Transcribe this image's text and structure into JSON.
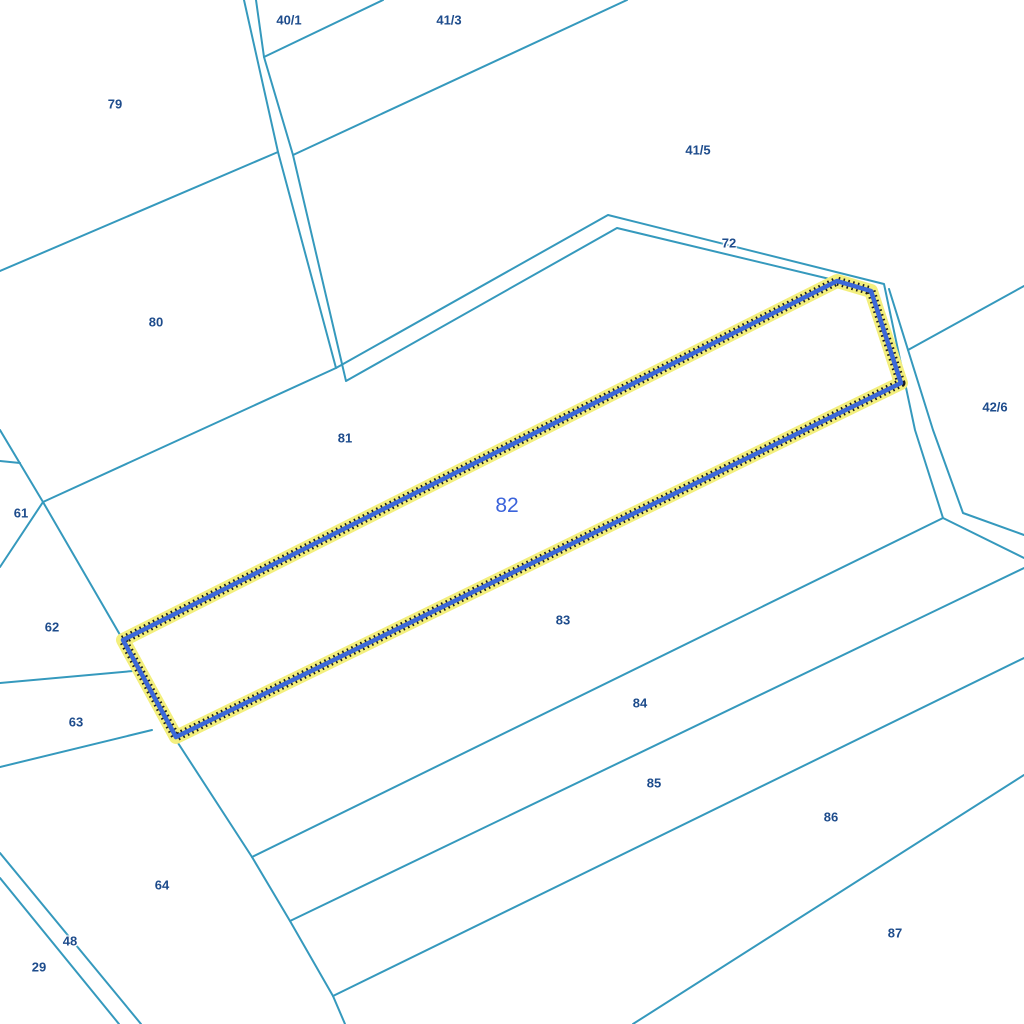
{
  "map": {
    "background_color": "#ffffff",
    "boundary_color": "#3599bd",
    "boundary_width": 2,
    "label_color": "#1e4c8c",
    "selected_label_color": "#3b63db",
    "highlight": {
      "halo_color": "#f3ef7d",
      "halo_width": 14,
      "dotted_color": "#1b1b1b",
      "dotted_width": 9,
      "dotted_dash": "1.6 3.4",
      "stroke_color": "#3c68d8",
      "stroke_width": 4.5
    },
    "selected_parcel": {
      "id": "82",
      "label_x": 507,
      "label_y": 506,
      "polygon": "123,640 837,281 871,291 901,383 176,737"
    },
    "parcels": [
      {
        "id": "79",
        "x": 115,
        "y": 104
      },
      {
        "id": "40/1",
        "x": 289,
        "y": 20
      },
      {
        "id": "41/3",
        "x": 449,
        "y": 20
      },
      {
        "id": "41/5",
        "x": 698,
        "y": 150
      },
      {
        "id": "72",
        "x": 729,
        "y": 243
      },
      {
        "id": "80",
        "x": 156,
        "y": 322
      },
      {
        "id": "42/6",
        "x": 995,
        "y": 407
      },
      {
        "id": "81",
        "x": 345,
        "y": 438
      },
      {
        "id": "61",
        "x": 21,
        "y": 513
      },
      {
        "id": "62",
        "x": 52,
        "y": 627
      },
      {
        "id": "83",
        "x": 563,
        "y": 620
      },
      {
        "id": "84",
        "x": 640,
        "y": 703
      },
      {
        "id": "63",
        "x": 76,
        "y": 722
      },
      {
        "id": "85",
        "x": 654,
        "y": 783
      },
      {
        "id": "86",
        "x": 831,
        "y": 817
      },
      {
        "id": "64",
        "x": 162,
        "y": 885
      },
      {
        "id": "87",
        "x": 895,
        "y": 933
      },
      {
        "id": "48",
        "x": 70,
        "y": 941
      },
      {
        "id": "29",
        "x": 39,
        "y": 967
      }
    ],
    "boundary_lines": [
      {
        "name": "road-nw-outer-edge",
        "points": "244,0 278,152 336,368 608,215 884,284 915,430 943,518 1024,558"
      },
      {
        "name": "road-nw-inner-edge",
        "points": "256,0 264,57 293,155 346,381 617,228 838,281"
      },
      {
        "name": "road-east-right-edge",
        "points": "889,289 933,430 963,513 1024,535"
      },
      {
        "name": "boundary-79-80",
        "points": "0,271 278,152"
      },
      {
        "name": "boundary-40-1-41-3",
        "points": "264,57 383,0"
      },
      {
        "name": "boundary-41-3-41-5",
        "points": "293,155 627,0"
      },
      {
        "name": "boundary-42-6-north",
        "points": "908,350 1024,286"
      },
      {
        "name": "boundary-80-81",
        "points": "336,368 43,502"
      },
      {
        "name": "boundary-west-upper",
        "points": "0,430 43,502"
      },
      {
        "name": "boundary-west-notch",
        "points": "0,461 20,463"
      },
      {
        "name": "boundary-61-62",
        "points": "43,502 0,567"
      },
      {
        "name": "boundary-62-81",
        "points": "43,502 123,640"
      },
      {
        "name": "boundary-62-63",
        "points": "0,683 133,671"
      },
      {
        "name": "boundary-63-64",
        "points": "0,767 152,730"
      },
      {
        "name": "boundary-64-east",
        "points": "178,743 252,857 290,921 333,996 345,1024"
      },
      {
        "name": "boundary-83-84",
        "points": "252,857 943,518"
      },
      {
        "name": "boundary-84-85",
        "points": "290,921 1024,568"
      },
      {
        "name": "boundary-85-86",
        "points": "333,996 1024,658"
      },
      {
        "name": "boundary-86-87",
        "points": "633,1024 1024,775"
      },
      {
        "name": "road-sw-upper-edge",
        "points": "0,853 141,1024"
      },
      {
        "name": "road-sw-lower-edge",
        "points": "0,878 119,1024"
      }
    ]
  }
}
